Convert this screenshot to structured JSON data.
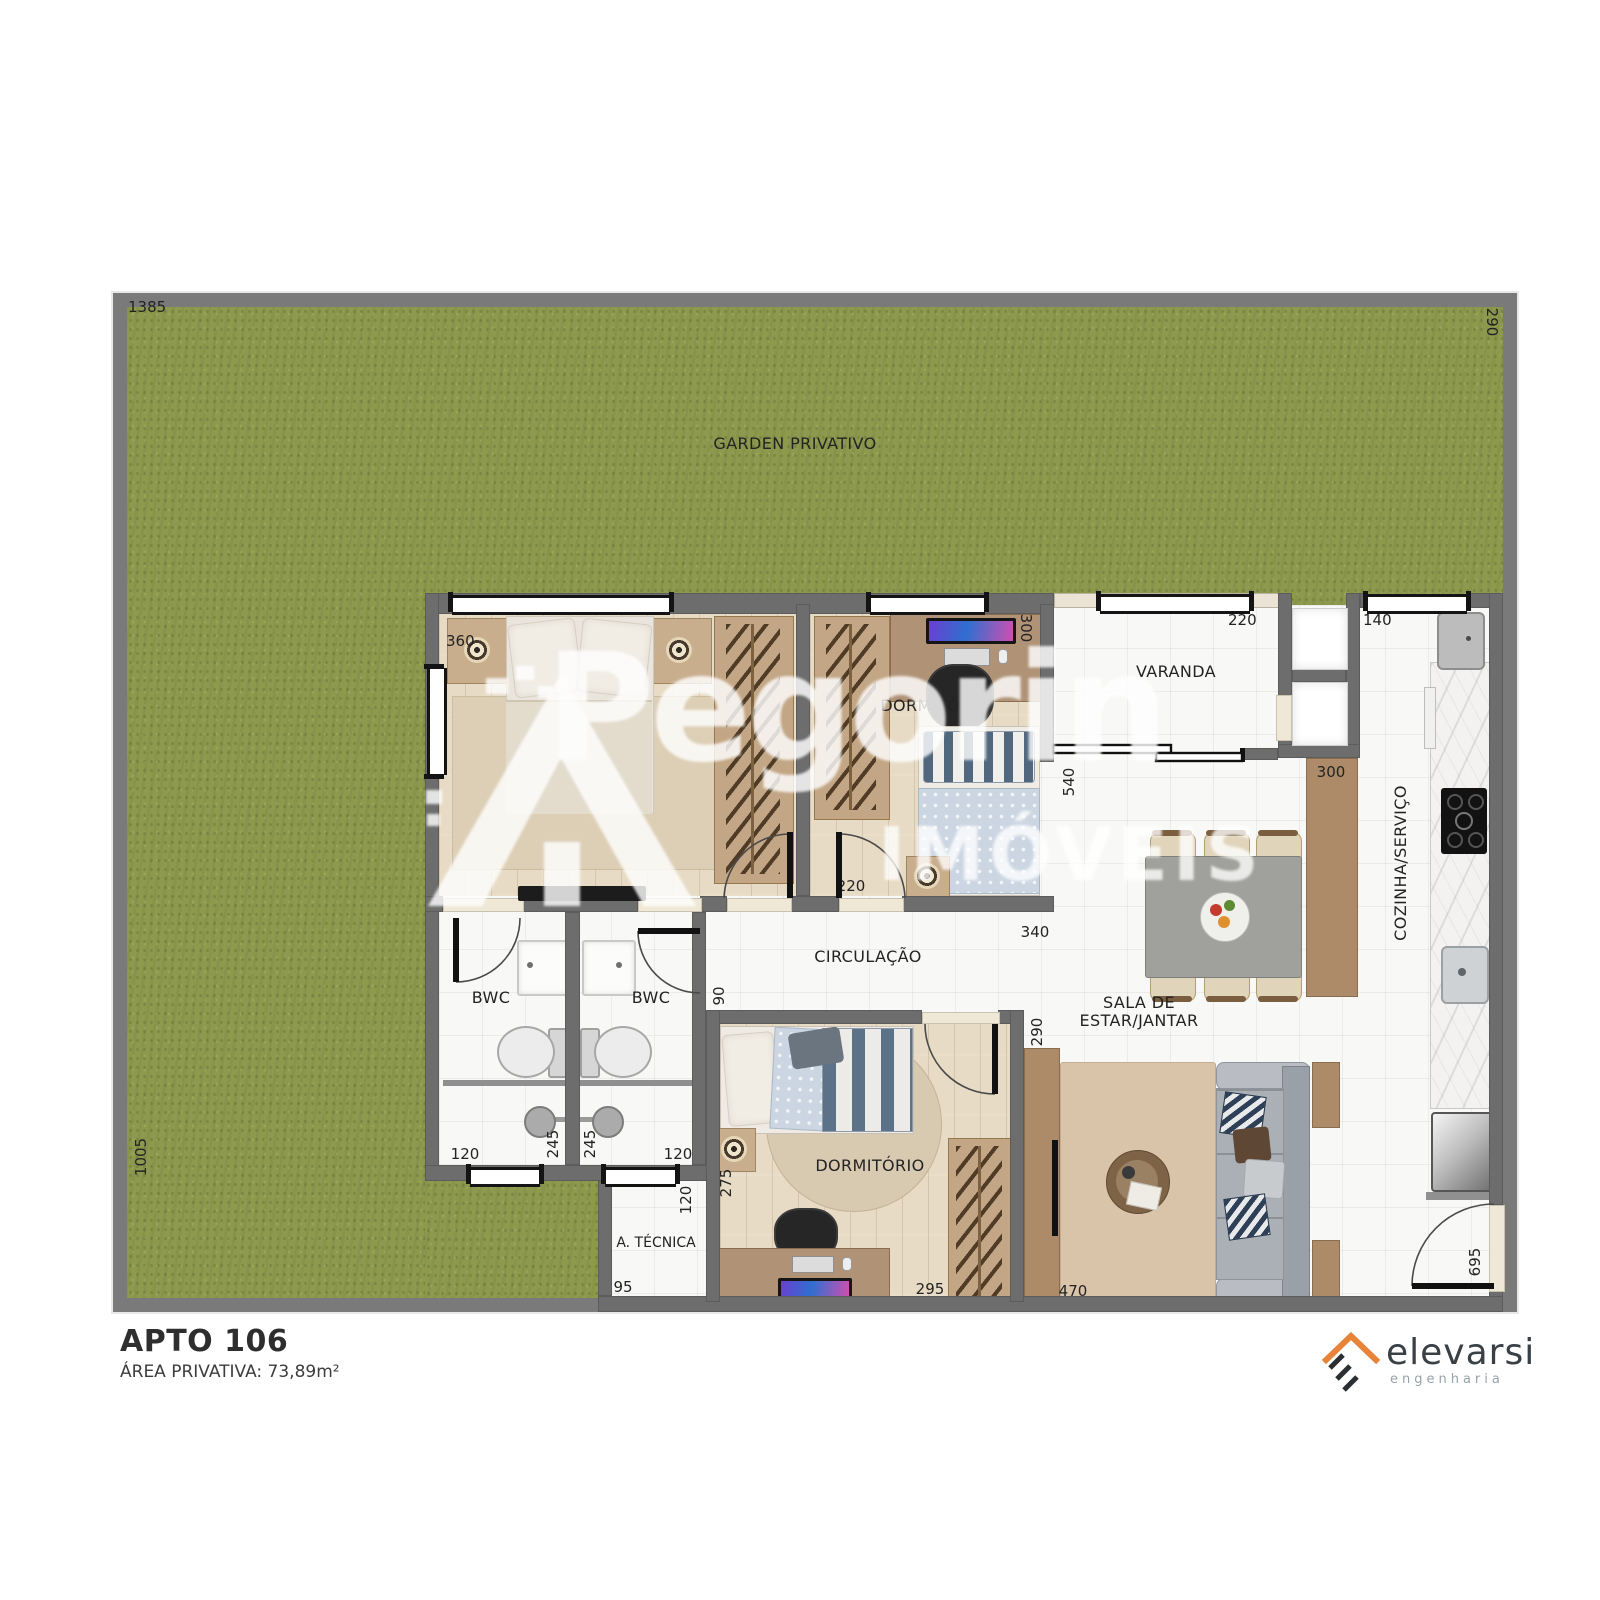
{
  "meta": {
    "plan_title": "APTO 106",
    "plan_area": "ÁREA PRIVATIVA: 73,89m²"
  },
  "watermark": {
    "brand": "Pegorin",
    "suffix": "IMÓVEIS"
  },
  "logo": {
    "name": "elevarsi",
    "tagline": "engenharia"
  },
  "garden": {
    "label": "GARDEN PRIVATIVO",
    "dim_top": "1385",
    "dim_right": "290",
    "dim_left": "1005"
  },
  "rooms": {
    "dorm1": {
      "dim_width": "360"
    },
    "dorm2": {
      "label": "DORMITÓRIO",
      "dim_depth": "300",
      "dim_door": "220"
    },
    "dorm3": {
      "label": "DORMITÓRIO",
      "dim_width": "295",
      "dim_left": "275"
    },
    "varanda": {
      "label": "VARANDA",
      "dim_window": "220",
      "dim_opening": "540"
    },
    "kitchen": {
      "label": "COZINHA/SERVIÇO",
      "dim_window": "140",
      "dim_counter": "300",
      "dim_entry": "695"
    },
    "circulation": {
      "label": "CIRCULAÇÃO",
      "dim_length": "340",
      "dim_width": "90"
    },
    "sala": {
      "label_line1": "SALA DE",
      "label_line2": "ESTAR/JANTAR",
      "dim_opening": "290",
      "dim_length": "470"
    },
    "bwc1": {
      "label": "BWC",
      "dim_window": "120",
      "dim_depth": "245"
    },
    "bwc2": {
      "label": "BWC",
      "dim_window": "120",
      "dim_depth": "245"
    },
    "atecnica": {
      "label": "A. TÉCNICA",
      "dim_width": "120",
      "dim_length": "95"
    }
  },
  "colors": {
    "grass": "#8d9a4e",
    "wall": "#6d6d6d",
    "wood": "#e7dbc5",
    "accent_orange": "#e8833a",
    "navy": "#2e4058"
  }
}
